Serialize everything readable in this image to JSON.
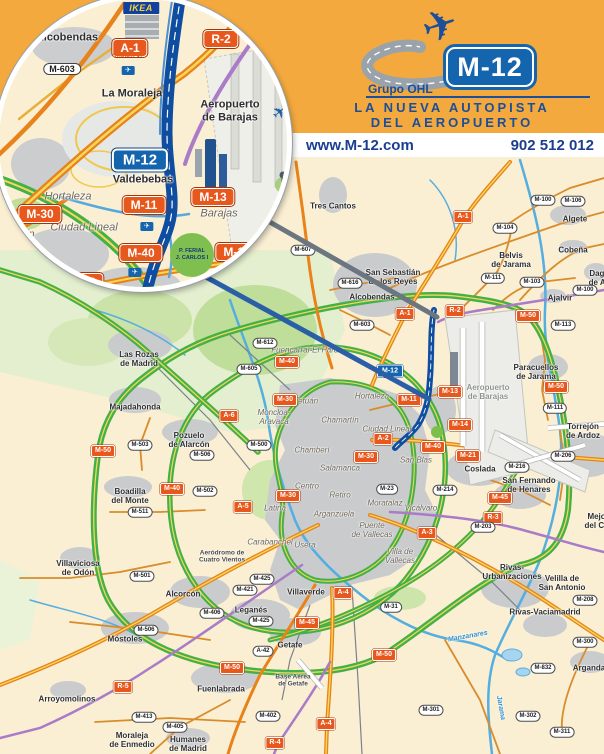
{
  "colors": {
    "banner_bg": "#F3A93E",
    "banner_blue": "#1B4E9B",
    "strip_bg": "#FFFFFF",
    "strip_text": "#1B3E91",
    "map_bg": "#FAEFD3",
    "urban": "#C9CBCD",
    "park": "#E4EFCF",
    "park_dark": "#BFDE9A",
    "road_green": "#44B049",
    "road_yellow": "#F5D75A",
    "road_orange": "#E8821A",
    "road_minor": "#D98C2B",
    "road_purple": "#A97BC8",
    "road_blue_light": "#57A8DC",
    "river": "#55AEE0",
    "m12_blue": "#0E4DA0",
    "sign_red": "#E8571C",
    "sign_blue": "#1565AE",
    "rail": "#7C8288"
  },
  "banner": {
    "group_label": "Grupo OHL",
    "shield_label": "M-12",
    "tagline_line1": "LA NUEVA AUTOPISTA",
    "tagline_line2": "DEL AEROPUERTO",
    "plane_icon": "✈"
  },
  "contact": {
    "website": "www.M-12.com",
    "phone": "902 512 012"
  },
  "inset": {
    "ikea_label": "IKEA",
    "ferial_label": "P. FERIAL\nJ. CARLOS I",
    "plane_icon": "✈",
    "exit_icon": "✈",
    "signs": [
      {
        "label": "A-1",
        "x": 131,
        "y": 49,
        "type": "sign-red"
      },
      {
        "label": "R-2",
        "x": 222,
        "y": 40,
        "type": "sign-red"
      },
      {
        "label": "M-603",
        "x": 63,
        "y": 70,
        "type": "sign-oval"
      },
      {
        "label": "M-12",
        "x": 141,
        "y": 161,
        "type": "sign-blue"
      },
      {
        "label": "M-11",
        "x": 145,
        "y": 206,
        "type": "sign-red"
      },
      {
        "label": "M-13",
        "x": 214,
        "y": 198,
        "type": "sign-red"
      },
      {
        "label": "M-30",
        "x": 41,
        "y": 215,
        "type": "sign-red"
      },
      {
        "label": "M-40",
        "x": 142,
        "y": 254,
        "type": "sign-red"
      },
      {
        "label": "M-14",
        "x": 238,
        "y": 253,
        "type": "sign-red"
      },
      {
        "label": "A-2",
        "x": 87,
        "y": 283,
        "type": "sign-red"
      }
    ],
    "places": [
      {
        "label": "Alcobendas",
        "x": 68,
        "y": 39,
        "type": "town-label"
      },
      {
        "label": "La Moraleja",
        "x": 133,
        "y": 95,
        "type": "town-label"
      },
      {
        "label": "Aeropuerto\nde Barajas",
        "x": 231,
        "y": 112,
        "type": "town-label"
      },
      {
        "label": "Valdebebas",
        "x": 144,
        "y": 181,
        "type": "town-label"
      },
      {
        "label": "Hortaleza",
        "x": 69,
        "y": 198,
        "type": "district-label"
      },
      {
        "label": "Ciudad Lineal",
        "x": 85,
        "y": 229,
        "type": "district-label"
      },
      {
        "label": "Barajas",
        "x": 220,
        "y": 215,
        "type": "district-label"
      },
      {
        "label": "Chamartín",
        "x": 10,
        "y": 236,
        "type": "district-label"
      }
    ],
    "salidas": [
      {
        "label": "SALIDA 17",
        "x": 129,
        "y": 66
      },
      {
        "label": "SALIDA 7",
        "x": 148,
        "y": 222
      },
      {
        "label": "SALIDA 8",
        "x": 136,
        "y": 268
      }
    ]
  },
  "map": {
    "signs": [
      {
        "label": "A-1",
        "x": 463,
        "y": 217,
        "type": "sign-red"
      },
      {
        "label": "A-1",
        "x": 405,
        "y": 314,
        "type": "sign-red"
      },
      {
        "label": "R-2",
        "x": 455,
        "y": 311,
        "type": "sign-red"
      },
      {
        "label": "M-50",
        "x": 528,
        "y": 316,
        "type": "sign-red"
      },
      {
        "label": "M-50",
        "x": 556,
        "y": 387,
        "type": "sign-red"
      },
      {
        "label": "M-50",
        "x": 103,
        "y": 451,
        "type": "sign-red"
      },
      {
        "label": "M-50",
        "x": 232,
        "y": 668,
        "type": "sign-red"
      },
      {
        "label": "M-50",
        "x": 384,
        "y": 655,
        "type": "sign-red"
      },
      {
        "label": "M-12",
        "x": 390,
        "y": 371,
        "type": "sign-blue"
      },
      {
        "label": "M-11",
        "x": 409,
        "y": 400,
        "type": "sign-red"
      },
      {
        "label": "M-13",
        "x": 450,
        "y": 392,
        "type": "sign-red"
      },
      {
        "label": "M-14",
        "x": 460,
        "y": 425,
        "type": "sign-red"
      },
      {
        "label": "M-40",
        "x": 287,
        "y": 362,
        "type": "sign-red"
      },
      {
        "label": "M-40",
        "x": 433,
        "y": 447,
        "type": "sign-red"
      },
      {
        "label": "M-40",
        "x": 172,
        "y": 489,
        "type": "sign-red"
      },
      {
        "label": "M-30",
        "x": 285,
        "y": 400,
        "type": "sign-red"
      },
      {
        "label": "M-30",
        "x": 366,
        "y": 457,
        "type": "sign-red"
      },
      {
        "label": "M-30",
        "x": 288,
        "y": 496,
        "type": "sign-red"
      },
      {
        "label": "A-2",
        "x": 383,
        "y": 439,
        "type": "sign-red"
      },
      {
        "label": "A-6",
        "x": 229,
        "y": 416,
        "type": "sign-red"
      },
      {
        "label": "A-5",
        "x": 243,
        "y": 507,
        "type": "sign-red"
      },
      {
        "label": "A-3",
        "x": 427,
        "y": 533,
        "type": "sign-red"
      },
      {
        "label": "A-4",
        "x": 343,
        "y": 593,
        "type": "sign-red"
      },
      {
        "label": "A-4",
        "x": 326,
        "y": 724,
        "type": "sign-red"
      },
      {
        "label": "R-3",
        "x": 493,
        "y": 518,
        "type": "sign-red"
      },
      {
        "label": "R-4",
        "x": 275,
        "y": 743,
        "type": "sign-red"
      },
      {
        "label": "R-5",
        "x": 123,
        "y": 687,
        "type": "sign-red"
      },
      {
        "label": "M-45",
        "x": 307,
        "y": 623,
        "type": "sign-red"
      },
      {
        "label": "M-45",
        "x": 500,
        "y": 498,
        "type": "sign-red"
      },
      {
        "label": "M-21",
        "x": 468,
        "y": 456,
        "type": "sign-red"
      },
      {
        "label": "M-607",
        "x": 303,
        "y": 250,
        "type": "sign-oval"
      },
      {
        "label": "M-616",
        "x": 350,
        "y": 283,
        "type": "sign-oval"
      },
      {
        "label": "M-603",
        "x": 362,
        "y": 325,
        "type": "sign-oval"
      },
      {
        "label": "M-612",
        "x": 265,
        "y": 343,
        "type": "sign-oval"
      },
      {
        "label": "M-605",
        "x": 249,
        "y": 369,
        "type": "sign-oval"
      },
      {
        "label": "M-104",
        "x": 505,
        "y": 228,
        "type": "sign-oval"
      },
      {
        "label": "M-103",
        "x": 532,
        "y": 282,
        "type": "sign-oval"
      },
      {
        "label": "M-100",
        "x": 543,
        "y": 200,
        "type": "sign-oval"
      },
      {
        "label": "M-106",
        "x": 573,
        "y": 201,
        "type": "sign-oval"
      },
      {
        "label": "M-100",
        "x": 585,
        "y": 290,
        "type": "sign-oval"
      },
      {
        "label": "M-111",
        "x": 493,
        "y": 278,
        "type": "sign-oval"
      },
      {
        "label": "M-113",
        "x": 563,
        "y": 325,
        "type": "sign-oval"
      },
      {
        "label": "M-111",
        "x": 555,
        "y": 408,
        "type": "sign-oval"
      },
      {
        "label": "M-503",
        "x": 140,
        "y": 445,
        "type": "sign-oval"
      },
      {
        "label": "M-500",
        "x": 259,
        "y": 445,
        "type": "sign-oval"
      },
      {
        "label": "M-502",
        "x": 205,
        "y": 491,
        "type": "sign-oval"
      },
      {
        "label": "M-511",
        "x": 140,
        "y": 512,
        "type": "sign-oval"
      },
      {
        "label": "M-506",
        "x": 202,
        "y": 455,
        "type": "sign-oval"
      },
      {
        "label": "M-501",
        "x": 142,
        "y": 576,
        "type": "sign-oval"
      },
      {
        "label": "M-425",
        "x": 262,
        "y": 579,
        "type": "sign-oval"
      },
      {
        "label": "M-421",
        "x": 245,
        "y": 590,
        "type": "sign-oval"
      },
      {
        "label": "M-406",
        "x": 212,
        "y": 613,
        "type": "sign-oval"
      },
      {
        "label": "M-425",
        "x": 261,
        "y": 621,
        "type": "sign-oval"
      },
      {
        "label": "A-42",
        "x": 263,
        "y": 651,
        "type": "sign-oval"
      },
      {
        "label": "M-31",
        "x": 391,
        "y": 607,
        "type": "sign-oval"
      },
      {
        "label": "M-23",
        "x": 387,
        "y": 489,
        "type": "sign-oval"
      },
      {
        "label": "M-214",
        "x": 445,
        "y": 490,
        "type": "sign-oval"
      },
      {
        "label": "M-216",
        "x": 517,
        "y": 467,
        "type": "sign-oval"
      },
      {
        "label": "M-206",
        "x": 563,
        "y": 456,
        "type": "sign-oval"
      },
      {
        "label": "M-203",
        "x": 483,
        "y": 527,
        "type": "sign-oval"
      },
      {
        "label": "M-208",
        "x": 585,
        "y": 600,
        "type": "sign-oval"
      },
      {
        "label": "M-301",
        "x": 431,
        "y": 710,
        "type": "sign-oval"
      },
      {
        "label": "M-311",
        "x": 562,
        "y": 732,
        "type": "sign-oval"
      },
      {
        "label": "M-300",
        "x": 585,
        "y": 642,
        "type": "sign-oval"
      },
      {
        "label": "M-832",
        "x": 543,
        "y": 668,
        "type": "sign-oval"
      },
      {
        "label": "M-302",
        "x": 528,
        "y": 716,
        "type": "sign-oval"
      },
      {
        "label": "M-506",
        "x": 146,
        "y": 630,
        "type": "sign-oval"
      },
      {
        "label": "M-413",
        "x": 144,
        "y": 717,
        "type": "sign-oval"
      },
      {
        "label": "M-405",
        "x": 175,
        "y": 727,
        "type": "sign-oval"
      },
      {
        "label": "M-402",
        "x": 268,
        "y": 716,
        "type": "sign-oval"
      }
    ],
    "towns": [
      {
        "label": "Tres Cantos",
        "x": 333,
        "y": 206
      },
      {
        "label": "San Sebastián\nde los Reyes",
        "x": 393,
        "y": 277
      },
      {
        "label": "Alcobendas",
        "x": 372,
        "y": 297
      },
      {
        "label": "Algete",
        "x": 575,
        "y": 219
      },
      {
        "label": "Cobeña",
        "x": 573,
        "y": 250
      },
      {
        "label": "Belvis\nde Jarama",
        "x": 511,
        "y": 260
      },
      {
        "label": "Ajalvir",
        "x": 560,
        "y": 298
      },
      {
        "label": "Daganzo\nde Arriba",
        "x": 606,
        "y": 278
      },
      {
        "label": "Paracuellos\nde Jarama",
        "x": 536,
        "y": 372
      },
      {
        "label": "Torrejón\nde Ardoz",
        "x": 583,
        "y": 431
      },
      {
        "label": "Coslada",
        "x": 480,
        "y": 469
      },
      {
        "label": "San Fernando\nde Henares",
        "x": 529,
        "y": 485
      },
      {
        "label": "Mejorada\ndel Campo",
        "x": 605,
        "y": 521
      },
      {
        "label": "Las Rozas\nde Madrid",
        "x": 139,
        "y": 359
      },
      {
        "label": "Majadahonda",
        "x": 135,
        "y": 407
      },
      {
        "label": "Pozuelo\nde Alarcón",
        "x": 189,
        "y": 440
      },
      {
        "label": "Boadilla\ndel Monte",
        "x": 130,
        "y": 496
      },
      {
        "label": "Villaviciosa\nde Odón",
        "x": 78,
        "y": 568
      },
      {
        "label": "Alcorcón",
        "x": 183,
        "y": 594
      },
      {
        "label": "Móstoles",
        "x": 125,
        "y": 639
      },
      {
        "label": "Arroyomolinos",
        "x": 67,
        "y": 699
      },
      {
        "label": "Moraleja\nde Enmedio",
        "x": 132,
        "y": 740
      },
      {
        "label": "Humanes\nde Madrid",
        "x": 188,
        "y": 744
      },
      {
        "label": "Leganés",
        "x": 251,
        "y": 610
      },
      {
        "label": "Fuenlabrada",
        "x": 221,
        "y": 689
      },
      {
        "label": "Getafe",
        "x": 290,
        "y": 645
      },
      {
        "label": "Villaverde",
        "x": 306,
        "y": 592
      },
      {
        "label": "Rivas-\nUrbanizaciones",
        "x": 512,
        "y": 572
      },
      {
        "label": "Velilla de\nSan Antonio",
        "x": 562,
        "y": 583
      },
      {
        "label": "Rivas-Vaciamadrid",
        "x": 545,
        "y": 612
      },
      {
        "label": "Arganda",
        "x": 589,
        "y": 668
      },
      {
        "label": "Base Aérea\nde Getafe",
        "x": 293,
        "y": 681,
        "cls": "sm"
      },
      {
        "label": "Aeródromo de\nCuatro Vientos",
        "x": 222,
        "y": 557,
        "cls": "sm"
      }
    ],
    "districts": [
      {
        "label": "Fuencarral-El Pardo",
        "x": 307,
        "y": 350
      },
      {
        "label": "Tetuán",
        "x": 306,
        "y": 401
      },
      {
        "label": "Hortaleza",
        "x": 372,
        "y": 396
      },
      {
        "label": "Chamartín",
        "x": 340,
        "y": 420
      },
      {
        "label": "Ciudad Lineal",
        "x": 387,
        "y": 429
      },
      {
        "label": "Moncloa-\nAravaca",
        "x": 274,
        "y": 417
      },
      {
        "label": "Chamberí",
        "x": 312,
        "y": 450
      },
      {
        "label": "Salamanca",
        "x": 340,
        "y": 468
      },
      {
        "label": "Centro",
        "x": 307,
        "y": 486
      },
      {
        "label": "Retiro",
        "x": 340,
        "y": 495
      },
      {
        "label": "Latina",
        "x": 275,
        "y": 508
      },
      {
        "label": "Arganzuela",
        "x": 334,
        "y": 514
      },
      {
        "label": "Carabanchel",
        "x": 270,
        "y": 542
      },
      {
        "label": "Usera",
        "x": 305,
        "y": 545
      },
      {
        "label": "Moratalaz",
        "x": 385,
        "y": 503
      },
      {
        "label": "Vicálvaro",
        "x": 421,
        "y": 508
      },
      {
        "label": "San Blas",
        "x": 416,
        "y": 460
      },
      {
        "label": "Puente\nde Vallecas",
        "x": 372,
        "y": 530
      },
      {
        "label": "Villa de\nVallecas",
        "x": 400,
        "y": 556
      },
      {
        "label": "Aeropuerto\nde Barajas",
        "x": 488,
        "y": 392,
        "cls": "airport"
      }
    ],
    "rivers": [
      {
        "label": "Manzanares",
        "x": 468,
        "y": 637,
        "rotate": -10
      },
      {
        "label": "Jarama",
        "x": 500,
        "y": 708,
        "rotate": 80
      }
    ]
  }
}
